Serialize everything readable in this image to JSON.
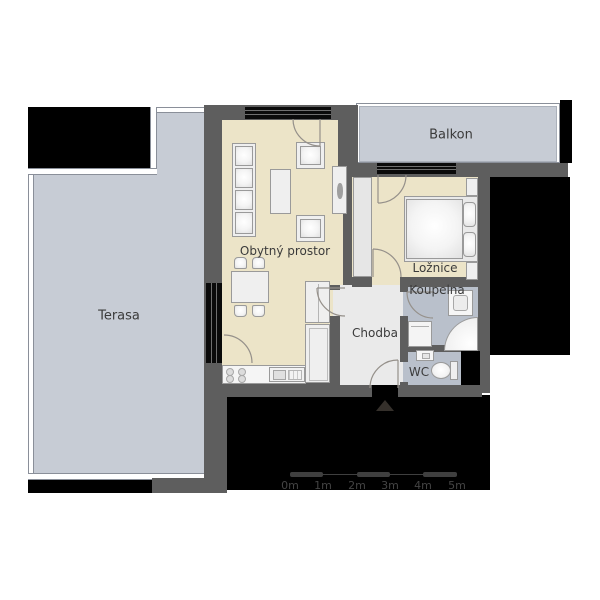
{
  "plan": {
    "rooms": [
      {
        "id": "terasa",
        "label": "Terasa"
      },
      {
        "id": "balkon",
        "label": "Balkon"
      },
      {
        "id": "obytny-prostor",
        "label": "Obytný prostor"
      },
      {
        "id": "loznice",
        "label": "Ložnice"
      },
      {
        "id": "koupelna",
        "label": "Koupelna"
      },
      {
        "id": "chodba",
        "label": "Chodba"
      },
      {
        "id": "wc",
        "label": "WC"
      }
    ],
    "scale_bar": {
      "labels": [
        "0m",
        "1m",
        "2m",
        "3m",
        "4m",
        "5m"
      ]
    },
    "colors": {
      "wall": "#5e5e5e",
      "living_floor": "#ece4c8",
      "wet_floor": "#b9c0cb",
      "hall_floor": "#eaeaea",
      "outdoor_floor": "#c7ccd5",
      "void": "#000000",
      "door_arc": "#95908a"
    }
  }
}
